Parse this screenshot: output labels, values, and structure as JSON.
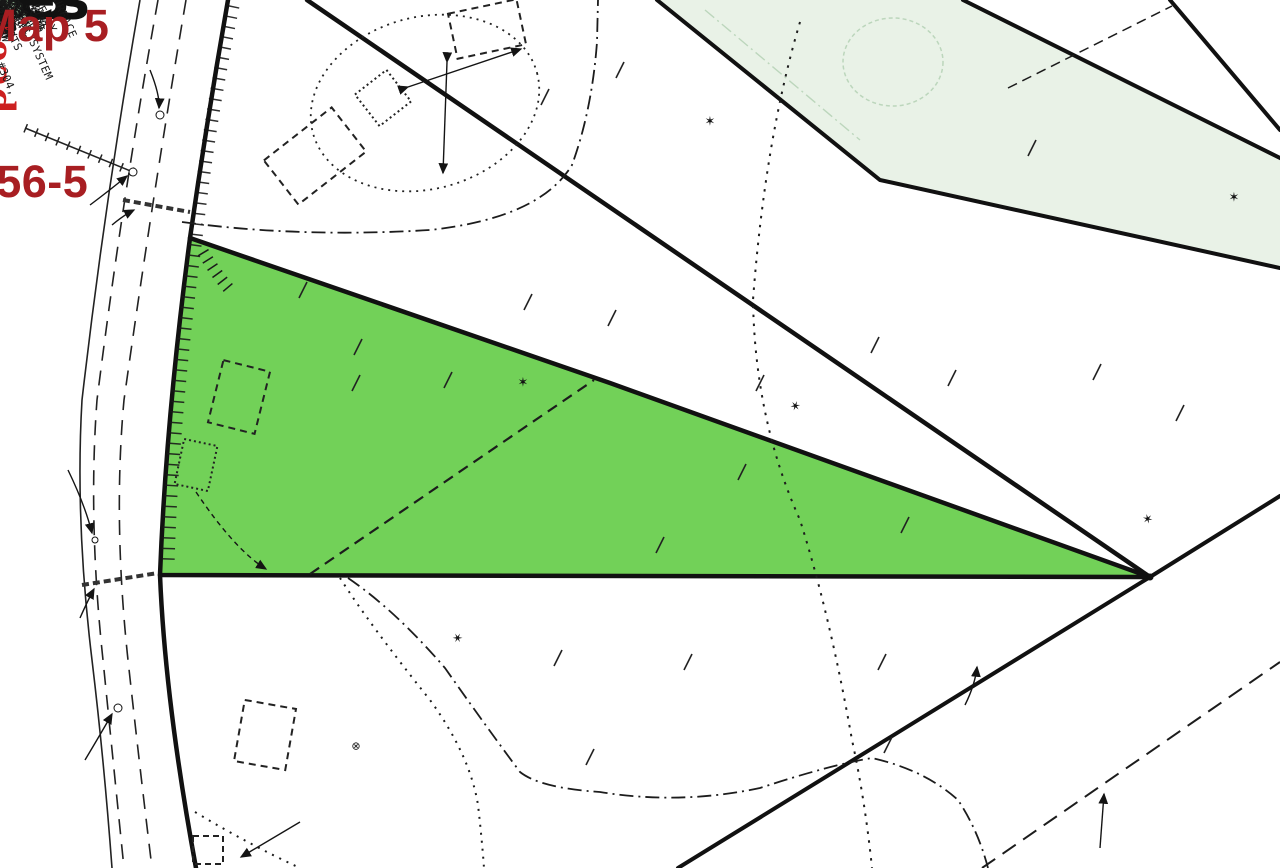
{
  "colors": {
    "highlight_green": "#72d158",
    "pale_green": "#e9f2e7",
    "address_red": "#a81e22",
    "road_name_red": "#cc2020",
    "faint_green_text": "#9dc49d",
    "line_black": "#141414"
  },
  "icons": {
    "wetland_marker": "✶"
  },
  "highlight": {
    "acreage_line1": "2.33",
    "acreage_line2": "Acres"
  },
  "address_overlay": {
    "line1": "56 Loop Road",
    "line2": "Tax Map 5",
    "line3": "Lot 56-5"
  },
  "road": {
    "name_overlay": "Loop Road",
    "word_loop": "LOOP",
    "word_road": "ROAD"
  },
  "lots": {
    "lot3_num": "3",
    "lot3_acres": "2.60 ACRES",
    "lot4_num": "4",
    "lot4_acres": "1.80 ACRES",
    "lot5_num": "5",
    "lot5_acres": "2.33 ACRES",
    "lot6_num": "6",
    "lot6_acres": "3.20 ACRES"
  },
  "labels": {
    "wilbur_l1": "R FORMERLY",
    "wilbur_l2": "HELLE WILBUR",
    "wilbur_l3": "8 - PG. 60",
    "wilbur_l4": "(LOT 55 D)",
    "pole911": "POLE 9/11",
    "ironpin_l1": "IRON PIN,",
    "ironpin_l2": "(FOUND)",
    "cmp15": "15\"CMP",
    "dennis_l1": "NOW OR",
    "dennis_l2": "DENNIS",
    "dennis_l3": "PRES.",
    "pole1012": "POLE 10/12",
    "cmp18": "18\"CMP",
    "dorothy_l1": "NOW OR FORMERLY",
    "dorothy_l2": "DOROTHY ROBERTS",
    "dorothy_l3": "BOOK 15",
    "pole7213": "POLE 72/13",
    "b3396": "33.96'",
    "b6051": "S60°51'42\"W",
    "d12893": "128.93'",
    "d1371": "137.1'",
    "b4852": "S48°52'19\"W",
    "d8401": "84.01'",
    "b3847": "S38°47'34\"W",
    "d6400": "64.00'",
    "d12847": "128.47'",
    "b3334": "S 33°34'36\"W",
    "d4295": "42.95'",
    "b3338": "S33°38'36\"W",
    "b2614": "S26°14'32\"W",
    "d22205": "222.05'",
    "drive_l1": "DRIVEWAY TO",
    "drive_l2": "BE LOCATED",
    "drive_l3": "HERE",
    "min100_a": "100' MIN",
    "min100_b": "100' MIN.",
    "min100_c": "100' MIN.",
    "wooded_l1": "(WOODED",
    "wooded_l2": "WETLAND)",
    "parcel4_l1": "PARCEL 4",
    "parcel4_l2": "BOOK 1590-PG.128",
    "parcel2_l1": "BOOK 1590-PG.128",
    "parcel2_l2": "PARCEL 2",
    "d75347": "753.47'",
    "b5447": "S54°47'41\"E",
    "b3500": "S35°00'49\"E",
    "d77992": "779.92'",
    "b2027": "S20°27'08\"E",
    "d78908": "789.08'",
    "d64835": "648.35'",
    "b1025": "S10°25'25\"E",
    "d94153": "941.53'",
    "b5604": "0°56'04\"E",
    "b0439": "N4°39'25\"E",
    "d63527": "635.27'",
    "corner_l1": "NOW OR FORMERLY",
    "corner_l2": "(STONES)",
    "corner_l3": "PG. 214",
    "acres_frag": "ACRES",
    "d11044": "110.44'",
    "b8605_r": "S86°05'50\"E",
    "b8605_b": "S86°05'50\"E",
    "d52165": "521.65'",
    "southerly_l1": "SOUTHERLY LINE",
    "southerly_l2": "OF PEASLEY,",
    "southerly_l3": "BOOK 1008-PG.344",
    "northerly_l1": "NORTHERLY",
    "northerly_l2": "BOOK",
    "cornerbr_l1": "BOOK",
    "cornerbr_l2": "(MAP",
    "septic_l1": "LOCATION OF SUBSURFACE",
    "septic_l2": "WASTEWATER DISPOSAL SYSTEM",
    "septic_l3": "BY JAMES MARPLE,S.E. #304,",
    "septic_l4": "TYPICAL.",
    "edge1_a": "EDGE",
    "edge1_b": "OF",
    "edge1_c": "WETLANDS",
    "edge2_a": "EDGE",
    "edge2_b": "OF",
    "edge2_c": "WETLAND",
    "c500": "500",
    "wood_l1": "WOOD",
    "wood_l2": "W/PILE",
    "wood_l3": "STONES"
  }
}
